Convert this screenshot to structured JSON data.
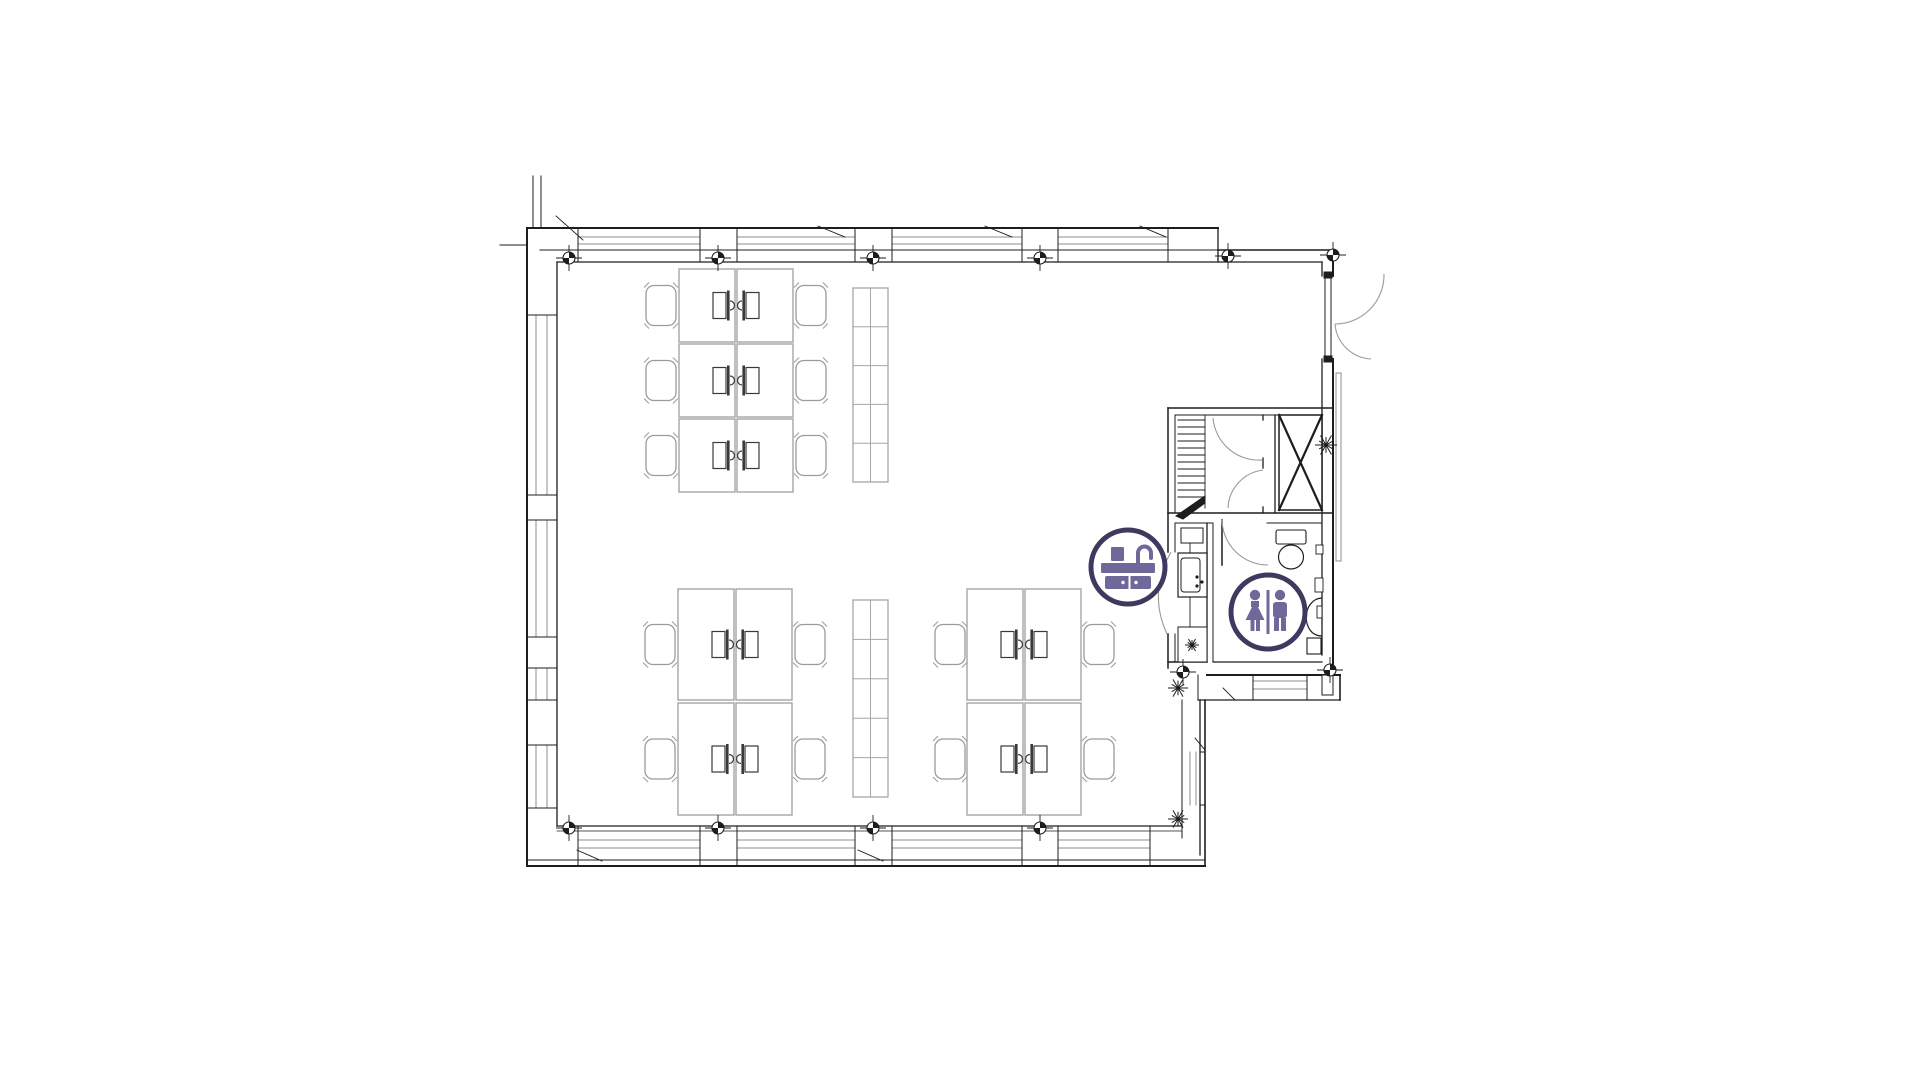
{
  "page": {
    "title": "Office floor plan",
    "background": "#ffffff"
  },
  "canvas": {
    "width": 1921,
    "height": 1080
  },
  "colors": {
    "wall": "#1d1d1f",
    "glaze": "#8d8d8d",
    "door": "#9a9a9a",
    "furniture": "#a5a5a5",
    "chair": "#9b9b9b",
    "shelf": "#a6a6a6",
    "monitor": "#3a3a3a",
    "badge_ring": "#3e3a5f",
    "badge_glyph": "#6f6999",
    "badge_bg": "#ffffff"
  },
  "legend": {
    "kitchen_badge": "kitchen-sink-icon",
    "restroom_badge": "restroom-icon"
  },
  "floor_plan": {
    "wall_lines": [
      [
        527,
        228,
        1218,
        228,
        2
      ],
      [
        557,
        262,
        1322,
        262,
        1.3
      ],
      [
        540,
        250,
        1218,
        250,
        1
      ],
      [
        1218,
        228,
        1218,
        262,
        1.3
      ],
      [
        1218,
        250,
        1333,
        250,
        1.6
      ],
      [
        527,
        228,
        527,
        866,
        2
      ],
      [
        557,
        262,
        557,
        826,
        1.3
      ],
      [
        533,
        176,
        533,
        228,
        1
      ],
      [
        541,
        176,
        541,
        228,
        1
      ],
      [
        500,
        245,
        527,
        245,
        1
      ],
      [
        527,
        866,
        1205,
        866,
        2
      ],
      [
        527,
        860,
        1205,
        860,
        1
      ],
      [
        557,
        826,
        1182,
        826,
        1.3
      ],
      [
        557,
        831,
        1182,
        831,
        0.8
      ],
      [
        1333,
        250,
        1333,
        276,
        2
      ],
      [
        1322,
        262,
        1322,
        276,
        1.3
      ],
      [
        1333,
        359,
        1333,
        675,
        2
      ],
      [
        1322,
        359,
        1322,
        655,
        1.3
      ],
      [
        1213,
        662,
        1322,
        662,
        1.3
      ],
      [
        1207,
        675,
        1340,
        675,
        2
      ],
      [
        1198,
        700,
        1340,
        700,
        1.3
      ],
      [
        1340,
        675,
        1340,
        700,
        1.6
      ],
      [
        1198,
        675,
        1198,
        700,
        1
      ],
      [
        1182,
        700,
        1182,
        838,
        1
      ],
      [
        1200,
        700,
        1200,
        855,
        1.3
      ],
      [
        1205,
        700,
        1205,
        866,
        1.6
      ],
      [
        1168,
        408,
        1333,
        408,
        1.5
      ],
      [
        1175,
        415,
        1322,
        415,
        1
      ],
      [
        1168,
        408,
        1168,
        552,
        1.5
      ],
      [
        1168,
        634,
        1168,
        668,
        1.5
      ],
      [
        1175,
        415,
        1175,
        513,
        1
      ],
      [
        1175,
        523,
        1175,
        552,
        1
      ],
      [
        1175,
        634,
        1175,
        662,
        1
      ],
      [
        1168,
        513,
        1333,
        513,
        1.5
      ],
      [
        1175,
        523,
        1213,
        523,
        1
      ],
      [
        1267,
        523,
        1322,
        523,
        1
      ],
      [
        1263,
        415,
        1263,
        420,
        1.3
      ],
      [
        1263,
        458,
        1263,
        468,
        1.3
      ],
      [
        1263,
        507,
        1263,
        513,
        1.3
      ],
      [
        1275,
        415,
        1275,
        513,
        1.3
      ],
      [
        1207,
        523,
        1207,
        662,
        1.3
      ],
      [
        1213,
        523,
        1213,
        662,
        1
      ],
      [
        1205,
        415,
        1205,
        508,
        0.9
      ],
      [
        1222,
        520,
        1222,
        565,
        1.5
      ],
      [
        1190,
        542,
        1190,
        627,
        0.9
      ],
      [
        1168,
        662,
        1207,
        662,
        1.5
      ],
      [
        578,
        228,
        578,
        262,
        1
      ],
      [
        700,
        228,
        700,
        262,
        1
      ],
      [
        737,
        228,
        737,
        262,
        1
      ],
      [
        855,
        228,
        855,
        262,
        1
      ],
      [
        892,
        228,
        892,
        262,
        1
      ],
      [
        1022,
        228,
        1022,
        262,
        1
      ],
      [
        1058,
        228,
        1058,
        262,
        1
      ],
      [
        1168,
        228,
        1168,
        262,
        1
      ],
      [
        578,
        826,
        578,
        866,
        1
      ],
      [
        700,
        826,
        700,
        866,
        1
      ],
      [
        737,
        826,
        737,
        866,
        1
      ],
      [
        855,
        826,
        855,
        866,
        1
      ],
      [
        892,
        826,
        892,
        866,
        1
      ],
      [
        1022,
        826,
        1022,
        866,
        1
      ],
      [
        1058,
        826,
        1058,
        866,
        1
      ],
      [
        1150,
        826,
        1150,
        866,
        1
      ],
      [
        527,
        315,
        557,
        315,
        1
      ],
      [
        527,
        495,
        557,
        495,
        1
      ],
      [
        527,
        520,
        557,
        520,
        1
      ],
      [
        527,
        637,
        557,
        637,
        1
      ],
      [
        527,
        668,
        557,
        668,
        1
      ],
      [
        527,
        700,
        557,
        700,
        1
      ],
      [
        527,
        745,
        557,
        745,
        1
      ],
      [
        527,
        808,
        557,
        808,
        1
      ],
      [
        1200,
        752,
        1205,
        752,
        1
      ],
      [
        1200,
        805,
        1205,
        805,
        1
      ],
      [
        1253,
        675,
        1253,
        700,
        1
      ],
      [
        1307,
        675,
        1307,
        700,
        1
      ]
    ],
    "glazing_lines": [
      [
        578,
        237,
        700,
        237
      ],
      [
        737,
        237,
        855,
        237
      ],
      [
        892,
        237,
        1022,
        237
      ],
      [
        1058,
        237,
        1168,
        237
      ],
      [
        578,
        244,
        700,
        244
      ],
      [
        737,
        244,
        855,
        244
      ],
      [
        892,
        244,
        1022,
        244
      ],
      [
        1058,
        244,
        1168,
        244
      ],
      [
        578,
        840,
        700,
        840
      ],
      [
        737,
        840,
        855,
        840
      ],
      [
        892,
        840,
        1022,
        840
      ],
      [
        1058,
        840,
        1150,
        840
      ],
      [
        578,
        848,
        700,
        848
      ],
      [
        737,
        848,
        855,
        848
      ],
      [
        892,
        848,
        1022,
        848
      ],
      [
        1058,
        848,
        1150,
        848
      ],
      [
        536,
        315,
        536,
        495
      ],
      [
        536,
        520,
        536,
        637
      ],
      [
        536,
        668,
        536,
        700
      ],
      [
        536,
        745,
        536,
        808
      ],
      [
        547,
        315,
        547,
        495
      ],
      [
        547,
        520,
        547,
        637
      ],
      [
        547,
        668,
        547,
        700
      ],
      [
        547,
        745,
        547,
        808
      ],
      [
        1190,
        752,
        1190,
        805
      ],
      [
        1196,
        752,
        1196,
        805
      ],
      [
        1253,
        681,
        1307,
        681
      ],
      [
        1253,
        689,
        1307,
        689
      ]
    ],
    "annotation_lines": [
      [
        556,
        216,
        583,
        240
      ],
      [
        818,
        226,
        845,
        237
      ],
      [
        985,
        226,
        1012,
        237
      ],
      [
        1140,
        226,
        1166,
        237
      ],
      [
        577,
        850,
        602,
        861
      ],
      [
        858,
        850,
        883,
        861
      ],
      [
        1223,
        688,
        1235,
        700
      ],
      [
        1195,
        738,
        1205,
        750
      ]
    ],
    "door_arcs": [
      {
        "d": "M1384,274 A49,49 0 0 1 1335,324",
        "name": "entrance-door-swing"
      },
      {
        "d": "M1335,324 A38,38 0 0 0 1371,359",
        "name": "entrance-door-swing"
      },
      {
        "d": "M1213,418 A46,46 0 0 0 1262,460",
        "name": "stair-door-swing"
      },
      {
        "d": "M1228,508 A40,40 0 0 1 1263,470",
        "name": "stair-door-swing"
      },
      {
        "d": "M1222,520 A46,46 0 0 0 1268,565",
        "name": "bathroom-door-swing"
      },
      {
        "d": "M1171,552 Q1148,593 1167,634",
        "name": "kitchenette-door-swing"
      }
    ],
    "rects": [
      {
        "x": 1325,
        "y": 277,
        "w": 6,
        "h": 81,
        "sw": 1,
        "name": "entrance-door-leaf"
      },
      {
        "x": 1324,
        "y": 272,
        "w": 8,
        "h": 6,
        "sw": 1,
        "fill": true,
        "name": "door-hinge"
      },
      {
        "x": 1324,
        "y": 356,
        "w": 8,
        "h": 6,
        "sw": 1,
        "fill": true,
        "name": "door-hinge"
      },
      {
        "x": 1279,
        "y": 415,
        "w": 43,
        "h": 95,
        "sw": 1.5,
        "name": "elevator-shaft"
      },
      {
        "x": 1322,
        "y": 675,
        "w": 11,
        "h": 20,
        "sw": 1,
        "name": "wall-step"
      },
      {
        "x": 1276,
        "y": 530,
        "w": 30,
        "h": 14,
        "sw": 1.1,
        "rx": 2,
        "name": "toilet-cistern"
      },
      {
        "x": 1307,
        "y": 638,
        "w": 14,
        "h": 16,
        "sw": 1.1,
        "name": "bathroom-bin"
      },
      {
        "x": 1316,
        "y": 545,
        "w": 7,
        "h": 9,
        "sw": 0.9,
        "name": "wall-fixture"
      },
      {
        "x": 1315,
        "y": 578,
        "w": 8,
        "h": 14,
        "sw": 0.9,
        "name": "wall-fixture"
      },
      {
        "x": 1317,
        "y": 606,
        "w": 5,
        "h": 12,
        "sw": 0.9,
        "name": "basin-tap"
      },
      {
        "x": 1181,
        "y": 528,
        "w": 22,
        "h": 15,
        "sw": 1,
        "name": "kitchen-wall-cabinet"
      },
      {
        "x": 1178,
        "y": 553,
        "w": 29,
        "h": 44,
        "sw": 1.2,
        "name": "kitchen-sink-unit"
      },
      {
        "x": 1181,
        "y": 558,
        "w": 19,
        "h": 34,
        "sw": 1,
        "rx": 3,
        "name": "kitchen-sink-bowl"
      },
      {
        "x": 1178,
        "y": 627,
        "w": 29,
        "h": 35,
        "sw": 1,
        "name": "kitchen-counter"
      },
      {
        "x": 1336,
        "y": 373,
        "w": 5,
        "h": 188,
        "sw": 1,
        "light": true,
        "name": "exterior-railing"
      }
    ],
    "ellipses": [
      {
        "cx": 1291,
        "cy": 557,
        "rx": 12.5,
        "ry": 12,
        "sw": 1.2,
        "name": "toilet-bowl"
      }
    ],
    "paths": [
      {
        "d": "M1322,598 C1301,599 1301,636 1322,636",
        "sw": 1.2,
        "name": "wash-basin"
      },
      {
        "d": "M1176,516 L1205,496 L1205,503 L1183,519 Z",
        "fill": true,
        "name": "stair-direction-arrow"
      }
    ],
    "dots": [
      [
        1197,
        577
      ],
      [
        1197,
        586
      ],
      [
        1202,
        582
      ]
    ],
    "shaft_cross": [
      [
        1279,
        415,
        1322,
        510,
        2.2
      ],
      [
        1322,
        415,
        1279,
        510,
        2.2
      ]
    ],
    "stairs": {
      "x1": 1178,
      "x2": 1205,
      "y0": 420,
      "step": 7,
      "count": 12
    },
    "markers": [
      [
        569,
        258
      ],
      [
        718,
        258
      ],
      [
        873,
        258
      ],
      [
        1040,
        258
      ],
      [
        1228,
        256
      ],
      [
        1333,
        255
      ],
      [
        569,
        828
      ],
      [
        718,
        828
      ],
      [
        873,
        828
      ],
      [
        1040,
        828
      ],
      [
        1183,
        672
      ],
      [
        1330,
        670
      ]
    ],
    "starbursts": [
      [
        1326,
        445,
        11
      ],
      [
        1178,
        688,
        10
      ],
      [
        1178,
        819,
        10
      ],
      [
        1192,
        645,
        7
      ]
    ],
    "shelving": [
      {
        "x": 853,
        "y": 288,
        "w": 35,
        "h": 194,
        "rows": 5,
        "name": "shelving-north"
      },
      {
        "x": 853,
        "y": 600,
        "w": 35,
        "h": 197,
        "rows": 5,
        "name": "shelving-south"
      }
    ],
    "desk_clusters": [
      {
        "name": "desk-cluster-northwest",
        "x": 679,
        "rows": [
          [
            269,
            73
          ],
          [
            344,
            73
          ],
          [
            419,
            73
          ]
        ],
        "desk_w": 56,
        "gap": 2,
        "chair_left_cx": 661,
        "chair_right_cx": 811
      },
      {
        "name": "desk-cluster-southwest",
        "x": 678,
        "rows": [
          [
            589,
            111
          ],
          [
            703,
            112
          ]
        ],
        "desk_w": 56,
        "gap": 2,
        "chair_left_cx": 660,
        "chair_right_cx": 810
      },
      {
        "name": "desk-cluster-south",
        "x": 967,
        "rows": [
          [
            589,
            111
          ],
          [
            703,
            112
          ]
        ],
        "desk_w": 56,
        "gap": 2,
        "chair_left_cx": 950,
        "chair_right_cx": 1099
      }
    ],
    "badges": [
      {
        "name": "kitchen-sink-icon",
        "cx": 1128,
        "cy": 567,
        "r": 37,
        "glyph": "sink"
      },
      {
        "name": "restroom-icon",
        "cx": 1268,
        "cy": 612,
        "r": 37,
        "glyph": "restroom"
      }
    ]
  }
}
